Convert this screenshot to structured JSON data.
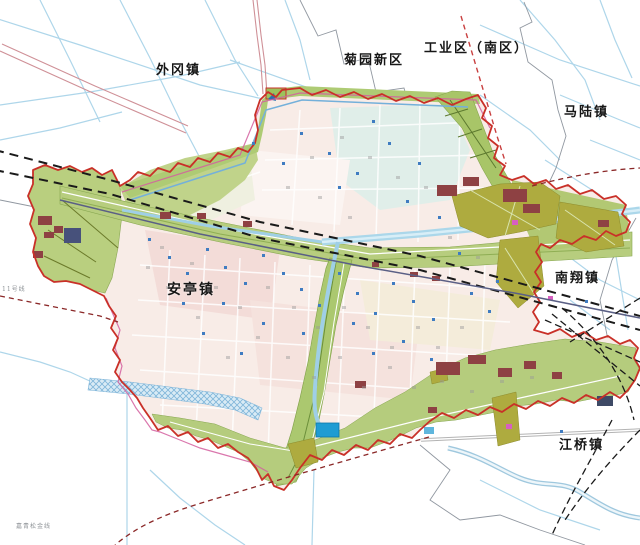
{
  "map": {
    "type": "urban land-use planning map",
    "region_labels": [
      {
        "id": "waigang",
        "text": "外冈镇"
      },
      {
        "id": "juyuan",
        "text": "菊园新区"
      },
      {
        "id": "industrial",
        "text": "工业区（南区）"
      },
      {
        "id": "malu",
        "text": "马陆镇"
      },
      {
        "id": "nanxiang",
        "text": "南翔镇"
      },
      {
        "id": "anting",
        "text": "安亭镇"
      },
      {
        "id": "jiangqiao",
        "text": "江桥镇"
      }
    ],
    "small_labels": [
      {
        "id": "rail-line-sw",
        "text": "嘉青松金线"
      },
      {
        "id": "rail-line-west",
        "text": "11号线"
      }
    ],
    "palette": {
      "boundary_red": "#c93028",
      "boundary_magenta": "#d45f9f",
      "corridor_green": "#b7cd7e",
      "greenbelt": "#aecb74",
      "industrial_olive": "#aeab3f",
      "block_maroon": "#8e4143",
      "block_slate": "#47517b",
      "river_blue": "#a9d2e8",
      "wide_river": "#abd7ea",
      "railway_black": "#1a1a1a",
      "metro_slate": "#5a5f85",
      "urban_pink": "#f8ece7",
      "urban_pink_deep": "#f3dcd8",
      "urban_teal": "#e0eee9",
      "water_fill": "#1f9cd3",
      "marker_blue": "#3f7cc1",
      "highway_pink": "#cf9097",
      "dashed_dark_red": "#8b2828",
      "admin_gray": "#9097a0",
      "label_black": "#161616"
    }
  }
}
